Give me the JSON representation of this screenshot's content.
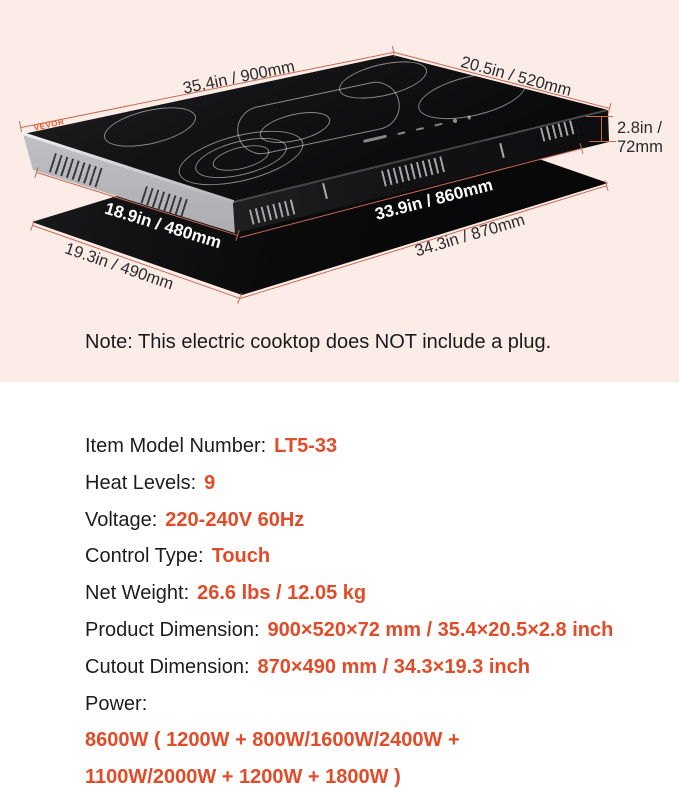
{
  "diagram": {
    "logo": "VEVOR",
    "dim_900": "35.4in / 900mm",
    "dim_520": "20.5in / 520mm",
    "dim_72_line1": "2.8in /",
    "dim_72_line2": "72mm",
    "dim_480": "18.9in / 480mm",
    "dim_860": "33.9in / 860mm",
    "dim_870": "34.3in / 870mm",
    "dim_490": "19.3in / 490mm",
    "note": "Note: This electric cooktop does NOT include a plug."
  },
  "specs": [
    {
      "label": "Item Model Number:",
      "value": "LT5-33"
    },
    {
      "label": "Heat Levels:",
      "value": "9"
    },
    {
      "label": "Voltage:",
      "value": "220-240V 60Hz"
    },
    {
      "label": "Control Type:",
      "value": "Touch"
    },
    {
      "label": "Net Weight:",
      "value": "26.6 lbs / 12.05 kg"
    },
    {
      "label": "Product Dimension:",
      "value": "900×520×72 mm / 35.4×20.5×2.8 inch"
    },
    {
      "label": "Cutout Dimension:",
      "value": "870×490 mm / 34.3×19.3 inch"
    },
    {
      "label": "Power:",
      "value": ""
    }
  ],
  "power_lines": [
    "8600W ( 1200W + 800W/1600W/2400W +",
    "1100W/2000W + 1200W + 1800W )"
  ],
  "colors": {
    "accent": "#e14b28",
    "dimension_line": "#c96a50",
    "background": "#fcece7"
  }
}
